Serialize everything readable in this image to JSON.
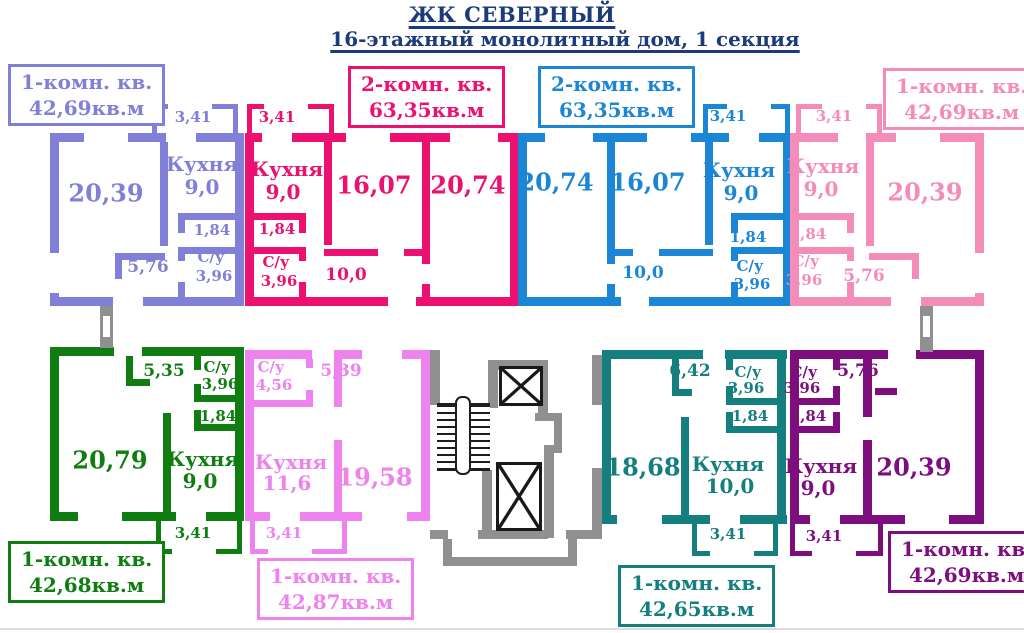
{
  "header": {
    "title": "ЖК СЕВЕРНЫЙ",
    "subtitle": "16-этажный монолитный дом, 1 секция",
    "color": "#1b3b7a"
  },
  "core": {
    "wall_color": "#909090"
  },
  "apartments": [
    {
      "name": "top-left",
      "type_label": "1-комн. кв.",
      "area_label": "42,69кв.м",
      "color": "#8080d8",
      "rooms": {
        "living": "20,39",
        "kitchen_name": "Кухня",
        "kitchen_area": "9,0",
        "balcony": "3,41",
        "hall": "1,84",
        "bath_name": "С/у",
        "bath_area": "3,96",
        "corridor": "5,76"
      }
    },
    {
      "name": "top-center-left",
      "type_label": "2-комн. кв.",
      "area_label": "63,35кв.м",
      "color": "#ec1070",
      "rooms": {
        "living": "20,74",
        "bedroom": "16,07",
        "kitchen_name": "Кухня",
        "kitchen_area": "9,0",
        "balcony": "3,41",
        "hall": "1,84",
        "bath_name": "С/у",
        "bath_area": "3,96",
        "corridor": "10,0"
      }
    },
    {
      "name": "top-center-right",
      "type_label": "2-комн. кв.",
      "area_label": "63,35кв.м",
      "color": "#1b85d6",
      "rooms": {
        "living": "20,74",
        "bedroom": "16,07",
        "kitchen_name": "Кухня",
        "kitchen_area": "9,0",
        "balcony": "3,41",
        "hall": "1,84",
        "bath_name": "С/у",
        "bath_area": "3,96",
        "corridor": "10,0"
      }
    },
    {
      "name": "top-right",
      "type_label": "1-комн. кв.",
      "area_label": "42,69кв.м",
      "color": "#f48cba",
      "rooms": {
        "living": "20,39",
        "kitchen_name": "Кухня",
        "kitchen_area": "9,0",
        "balcony": "3,41",
        "hall": "1,84",
        "bath_name": "С/у",
        "bath_area": "3,96",
        "corridor": "5,76"
      }
    },
    {
      "name": "bottom-left",
      "type_label": "1-комн. кв.",
      "area_label": "42,68кв.м",
      "color": "#0f7d0f",
      "rooms": {
        "living": "20,79",
        "kitchen_name": "Кухня",
        "kitchen_area": "9,0",
        "balcony": "3,41",
        "hall": "1,84",
        "bath_name": "С/у",
        "bath_area": "3,96",
        "corridor": "5,35"
      }
    },
    {
      "name": "bottom-center-left",
      "type_label": "1-комн. кв.",
      "area_label": "42,87кв.м",
      "color": "#ee82ee",
      "rooms": {
        "living": "19,58",
        "kitchen_name": "Кухня",
        "kitchen_area": "11,6",
        "balcony": "3,41",
        "bath_name": "С/у",
        "bath_area": "4,56",
        "corridor": "5,39"
      }
    },
    {
      "name": "bottom-center-right",
      "type_label": "1-комн. кв.",
      "area_label": "42,65кв.м",
      "color": "#157f7f",
      "rooms": {
        "living": "18,68",
        "kitchen_name": "Кухня",
        "kitchen_area": "10,0",
        "balcony": "3,41",
        "hall": "1,84",
        "bath_name": "С/у",
        "bath_area": "3,96",
        "corridor": "6,42"
      }
    },
    {
      "name": "bottom-right",
      "type_label": "1-комн. кв.",
      "area_label": "42,69кв.м",
      "color": "#7d0e7d",
      "rooms": {
        "living": "20,39",
        "kitchen_name": "Кухня",
        "kitchen_area": "9,0",
        "balcony": "3,41",
        "hall": "1,84",
        "bath_name": "С/у",
        "bath_area": "3,96",
        "corridor": "5,76"
      }
    }
  ]
}
